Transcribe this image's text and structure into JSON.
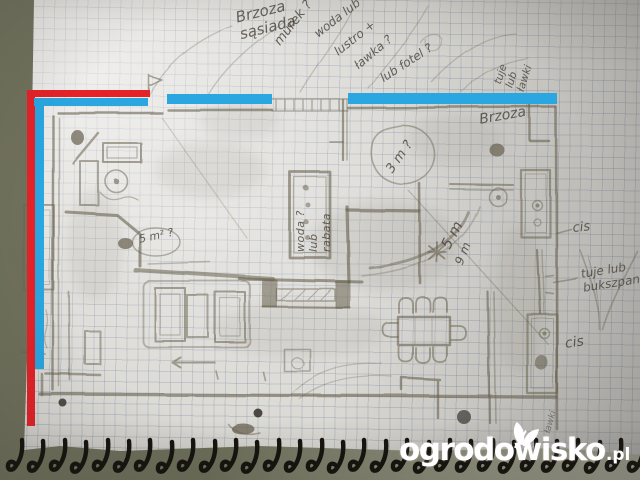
{
  "watermark": {
    "site": "ogrodowisko",
    "tld": ".pl",
    "icon": "leaf-icon"
  },
  "overlay_colors": {
    "blue": "#2aa6e0",
    "red": "#e52228"
  },
  "handwriting": {
    "brzoza_sasiada": "Brzoza\nsąsiada",
    "murek": "murek ?",
    "woda_lub": "woda lub",
    "lustro": "lustro +",
    "lawka": "ławka ?",
    "lub_fotel": "lub fotel ?",
    "tuje_lawki": "tuje\nlub\nławki",
    "brzoza_right": "Brzoza",
    "cis_upper": "cis",
    "tuje_bukszpan": "tuje lub\nbukszpan",
    "cis_lower": "cis",
    "lawki_edge": "ławki",
    "rabata_note": "woda ?\nlub\nrabata",
    "dim_3m": "3 m ?",
    "dim_5m": "5 m",
    "dim_9m": "9 m",
    "dim_cloud": "5 m² ?"
  }
}
